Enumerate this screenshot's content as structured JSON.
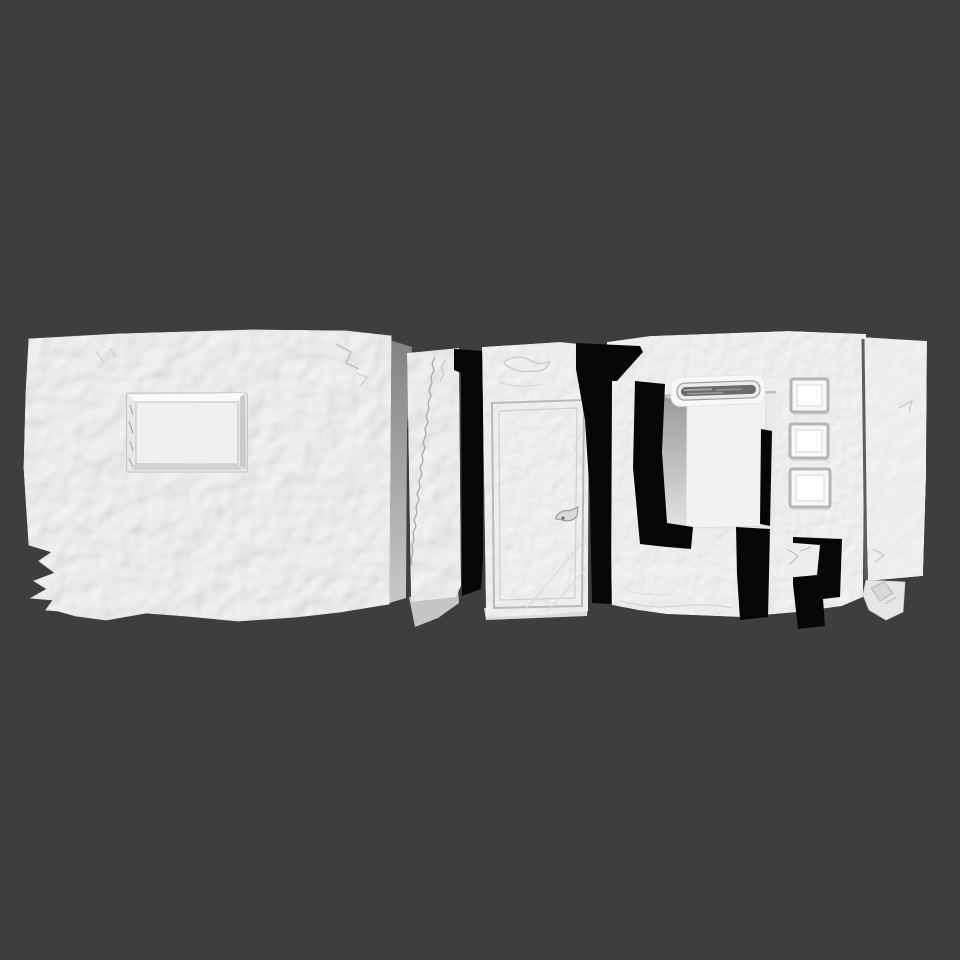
{
  "viewport": {
    "width": 960,
    "height": 960,
    "label": "3D mesh render viewport"
  },
  "colors": {
    "background": "#3e3e3e",
    "mesh_white": "#f2f2f2",
    "mesh_recess": "#e9e9e9",
    "hole_black": "#060606",
    "side_face_dark": "#828282",
    "side_face_light": "#c8c8c8",
    "strip_gray": "#dcdcdc",
    "slot_interior": "#6b6b6b",
    "seam_dark": "#5e5e5e",
    "rubble_gray": "#e6e6e6"
  },
  "scene": {
    "kind": "3d-scanned-mesh",
    "description": "Top-down orthographic render of a white 3D-scanned facade fragment lying horizontally on a dark gray background; unscanned regions appear as black holes.",
    "pieces": [
      {
        "id": "left-slab",
        "label": "Large crumpled slab with recessed rectangular niche and chipped lower-left corner"
      },
      {
        "id": "crack-strip",
        "label": "Narrow strip with meandering vertical crack"
      },
      {
        "id": "door-panel",
        "label": "Panel with inset rectangular door frame and small handle mark"
      },
      {
        "id": "console-panel",
        "label": "Panel with horizontal slot, three square insets and recessed doorway"
      },
      {
        "id": "right-slab",
        "label": "Tall plain slab with rubble fragment at its base"
      }
    ]
  }
}
